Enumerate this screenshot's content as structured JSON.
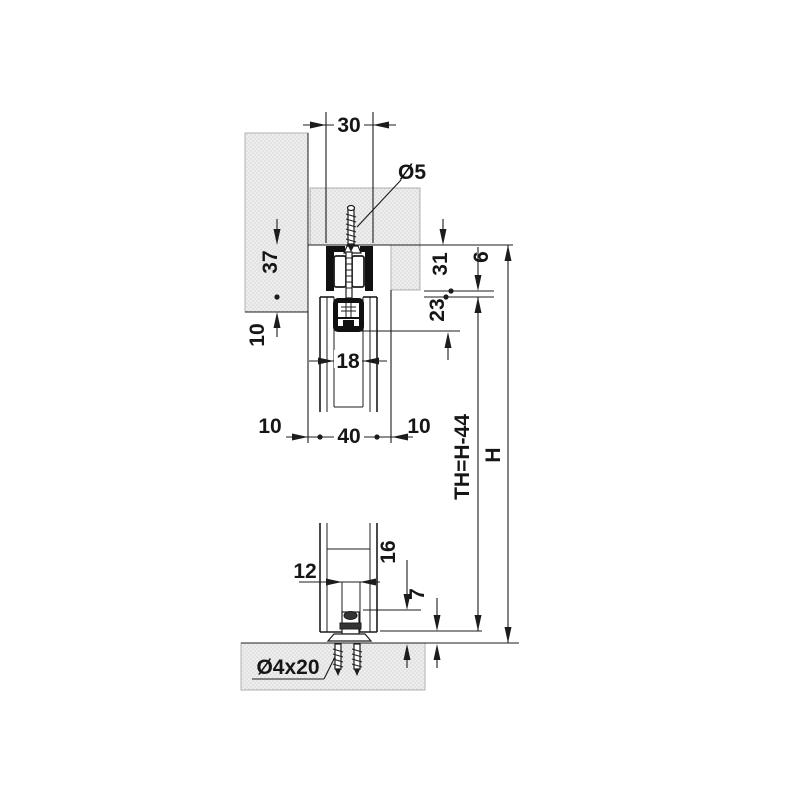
{
  "colors": {
    "background": "#ffffff",
    "panel_fill": "#ededed",
    "panel_stipple": "#c6c6c6",
    "panel_edge": "#b0b0b0",
    "line": "#1c1c1c",
    "fitting_fill": "#111111",
    "text": "#161616"
  },
  "diagram": {
    "type": "technical-drawing",
    "subject": "top-hung sliding door fitting, vertical cross-section with mounting dimensions",
    "labels": {
      "track_width": "30",
      "track_screw": "Ø5",
      "top_panel_to_door": "37",
      "surface_to_track_bottom": "31",
      "track_to_door_gap": "6",
      "door_top_to_hanger_bottom": "23",
      "wall_overlap": "10",
      "hanger_groove_width": "18",
      "left_clearance": "10",
      "door_thickness": "40",
      "right_clearance": "10",
      "door_height": "TH=H-44",
      "opening_height": "H",
      "guide_groove_width": "12",
      "guide_height": "16",
      "floor_gap": "7",
      "floor_screw": "Ø4x20"
    }
  }
}
